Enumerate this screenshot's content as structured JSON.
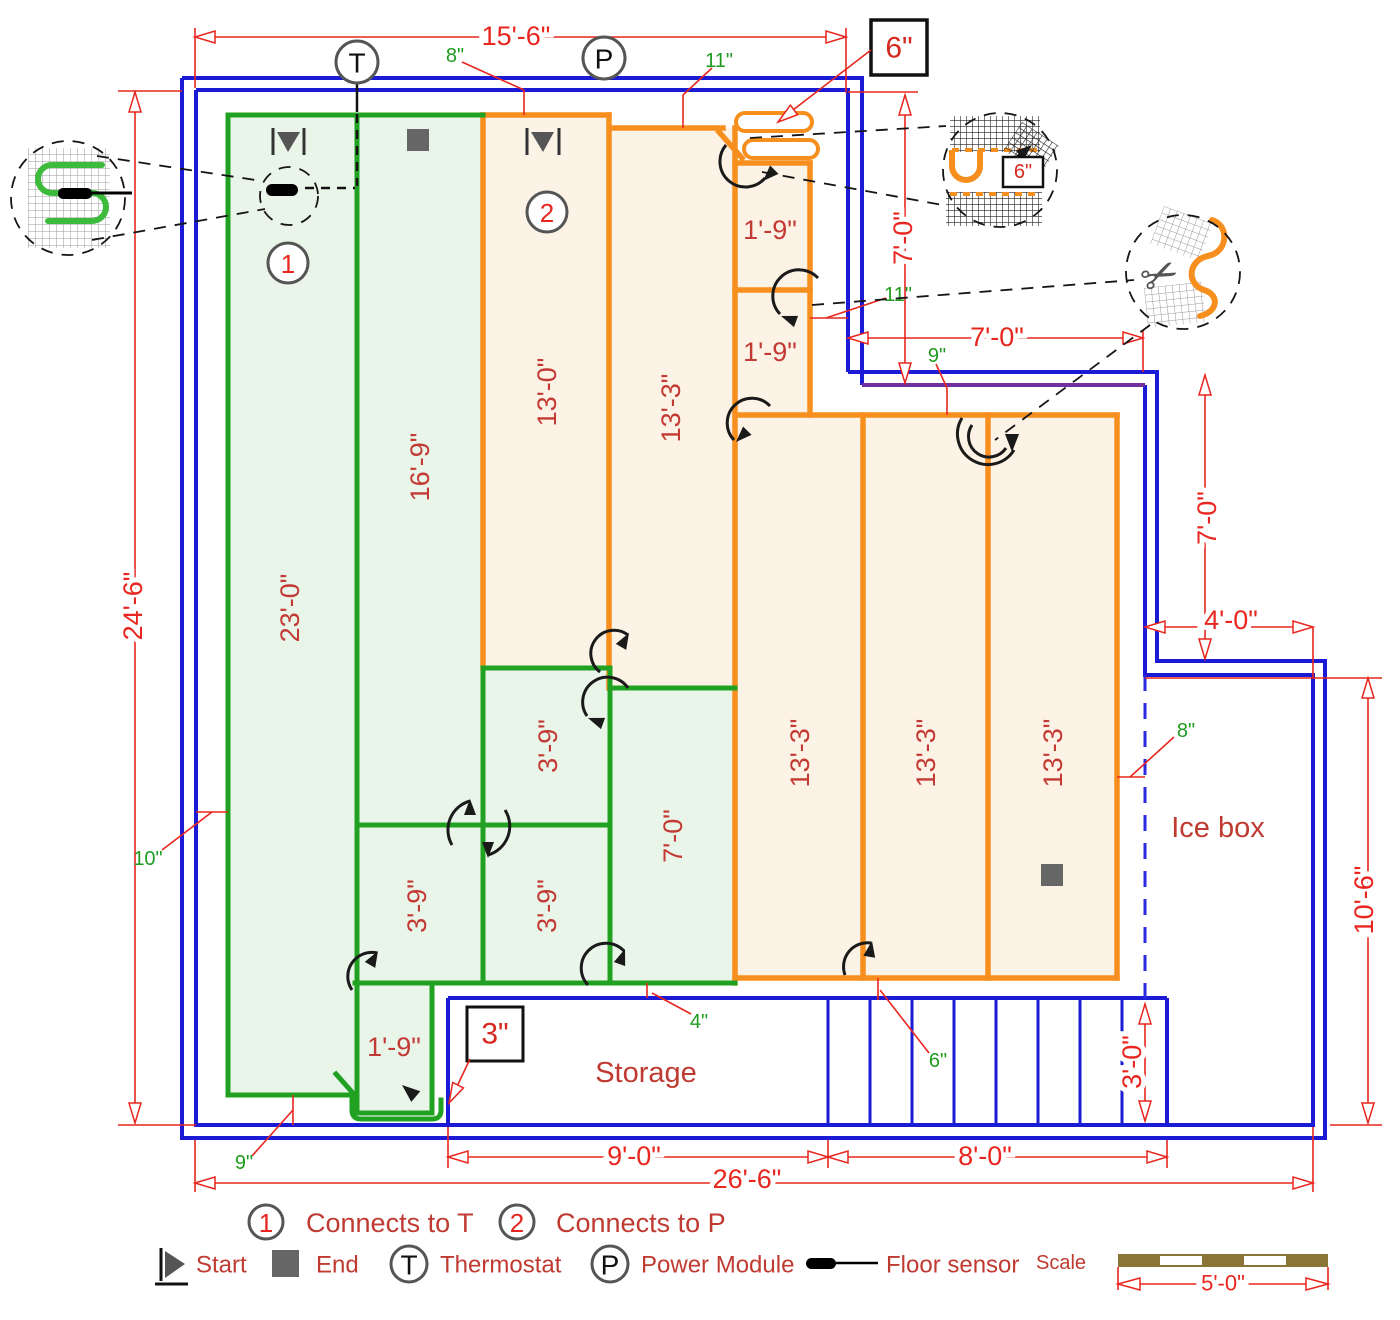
{
  "plan": {
    "dims": {
      "top_width": "15'-6\"",
      "left_height": "24'-6\"",
      "notch_height": "7'-0\"",
      "notch_width": "7'-0\"",
      "right_step_height": "7'-0\"",
      "icebox_top_width": "4'-0\"",
      "icebox_right_height": "10'-6\"",
      "stairs_height": "3'-0\"",
      "storage_width": "9'-0\"",
      "stairs_width": "8'-0\"",
      "overall_width": "26'-6\"",
      "scale_length": "5'-0\""
    },
    "offsets": {
      "top_8": "8\"",
      "top_11": "11\"",
      "right_11": "11\"",
      "right_9": "9\"",
      "icebox_8": "8\"",
      "left_10": "10\"",
      "bottom_left_9": "9\"",
      "bottom_4": "4\"",
      "stairs_6": "6\""
    },
    "callout_boxes": {
      "cable_spacing": "6\"",
      "edge_gap": "3\"",
      "detail_spacing": "6\""
    },
    "mats": {
      "green_23": "23'-0\"",
      "green_16_9": "16'-9\"",
      "green_3_9_top": "3'-9\"",
      "green_3_9_left": "3'-9\"",
      "green_3_9_mid": "3'-9\"",
      "green_7_0": "7'-0\"",
      "green_1_9": "1'-9\"",
      "orange_13_0": "13'-0\"",
      "orange_13_3_top": "13'-3\"",
      "orange_1_9_a": "1'-9\"",
      "orange_1_9_b": "1'-9\"",
      "orange_13_3_a": "13'-3\"",
      "orange_13_3_b": "13'-3\"",
      "orange_13_3_c": "13'-3\""
    },
    "rooms": {
      "storage": "Storage",
      "icebox": "Ice box"
    },
    "markers": {
      "num1": "1",
      "num2": "2",
      "thermostat": "T",
      "power": "P"
    }
  },
  "legend": {
    "num1": "1",
    "num1_label": "Connects to T",
    "num2": "2",
    "num2_label": "Connects to P",
    "start": "Start",
    "end": "End",
    "t_symbol": "T",
    "thermostat": "Thermostat",
    "p_symbol": "P",
    "power": "Power Module",
    "floor_sensor": "Floor sensor",
    "scale_label": "Scale"
  }
}
